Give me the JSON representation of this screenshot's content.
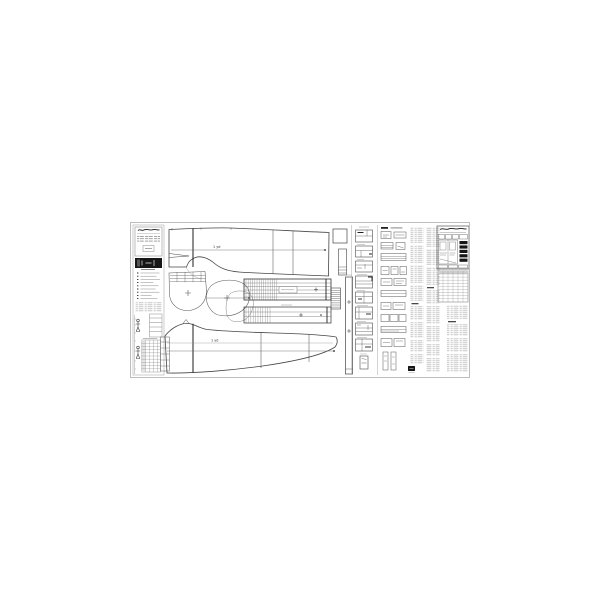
{
  "page": {
    "background": "#ffffff"
  },
  "sheet": {
    "kind": "garment pattern plan sheet (technical drawing)",
    "border_color": "#bdbdbd",
    "line_color": "#424242",
    "faint_color": "#9a9a9a",
    "ink_color": "#161616",
    "table_shade": "#e4e4e4"
  },
  "labels": {
    "front_piece_yardage": "1 yd",
    "back_piece_yardage": "1 yd"
  }
}
